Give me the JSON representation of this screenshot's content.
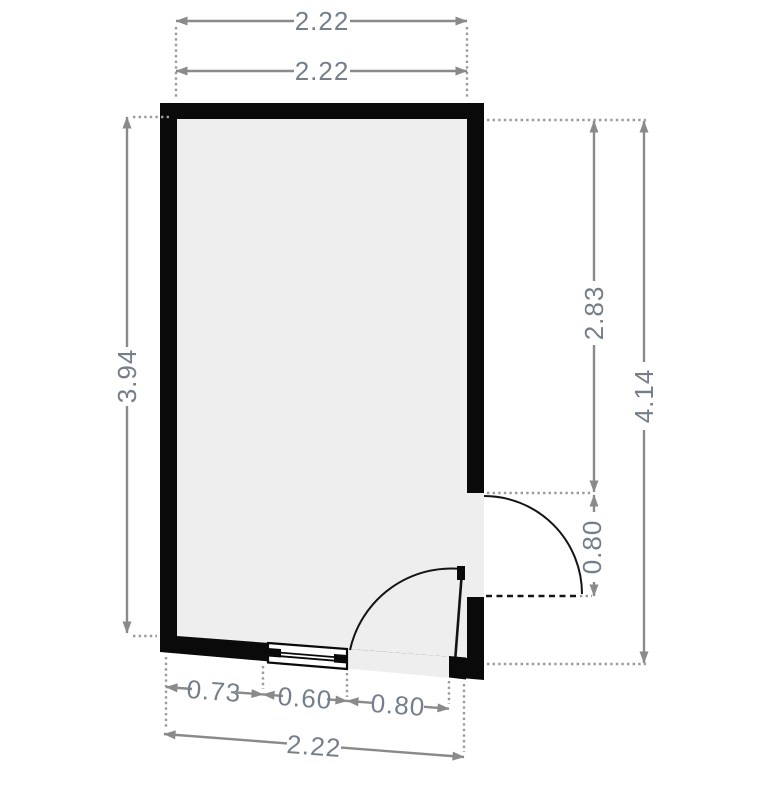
{
  "plan": {
    "type": "floor-plan",
    "room": {
      "shape": "quadrilateral (bottom wall slopes down to the right)",
      "features": [
        "window in bottom wall",
        "door in bottom wall opening inward",
        "door in right wall opening outward"
      ]
    },
    "colors": {
      "wall": "#0a0a0a",
      "floor": "#eeeeee",
      "dimension_line": "#8a8a8a",
      "extension_dots": "#9b9b9b",
      "dimension_text": "#757f8b",
      "background": "#ffffff"
    },
    "dimensions": {
      "top_outer": "2.22",
      "top_inner": "2.22",
      "left_height": "3.94",
      "right_upper": "2.83",
      "right_door_height": "0.80",
      "right_total": "4.14",
      "bottom_wall_segment": "0.73",
      "bottom_window_width": "0.60",
      "bottom_door_width": "0.80",
      "bottom_total": "2.22"
    }
  }
}
